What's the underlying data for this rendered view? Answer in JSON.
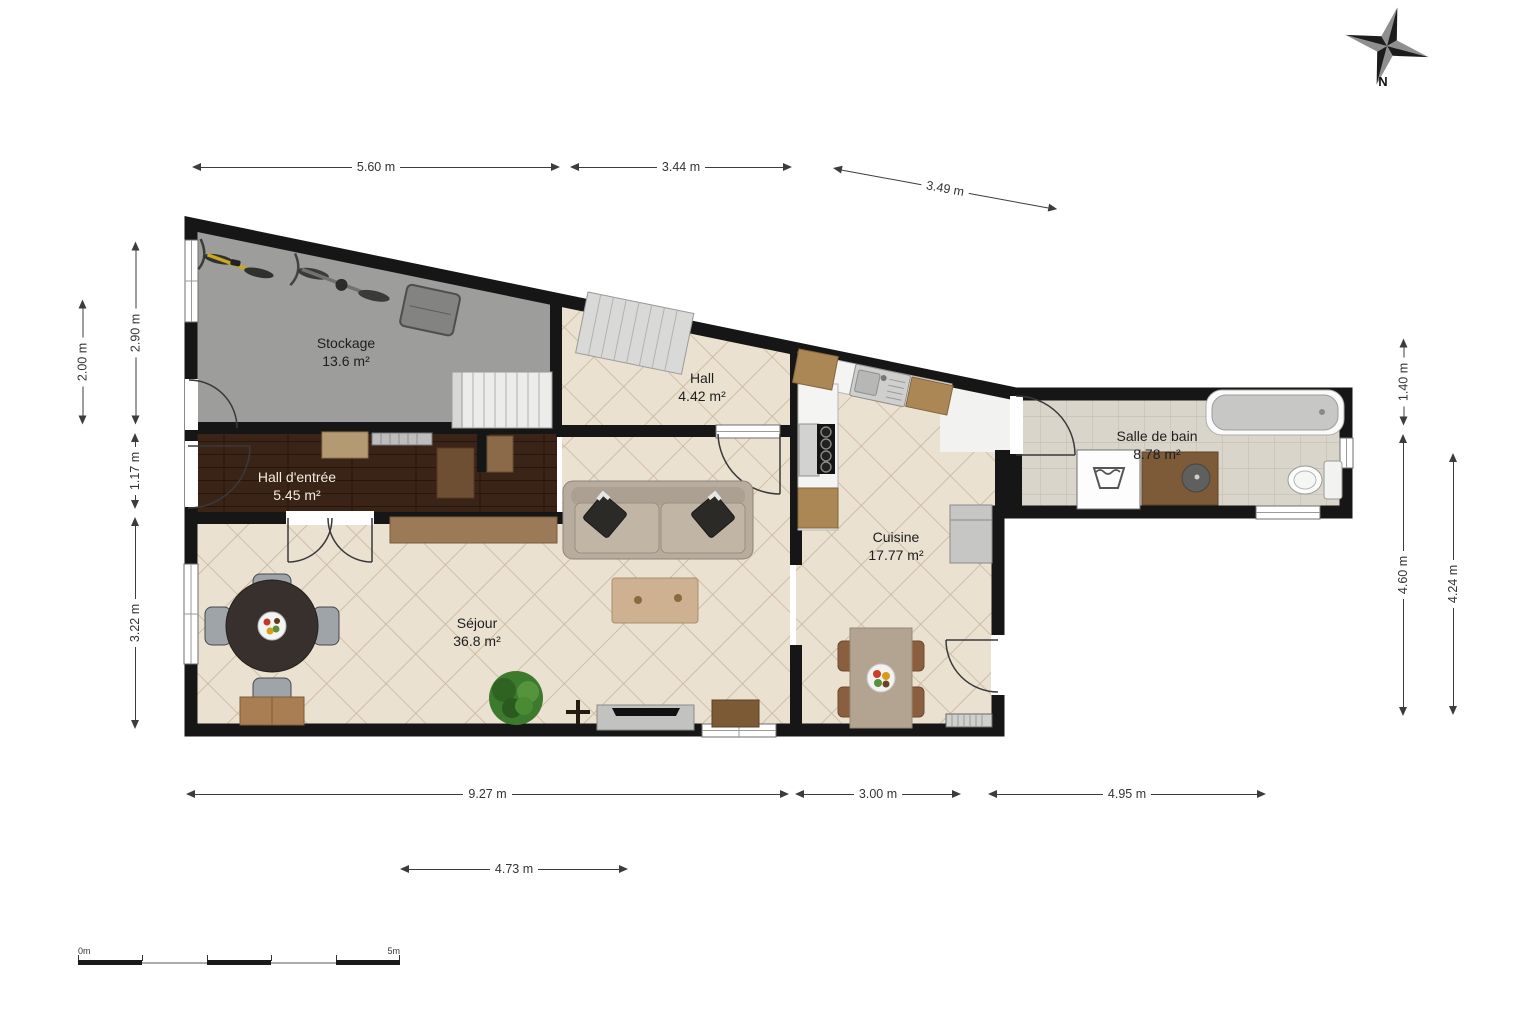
{
  "compass": {
    "label": "N"
  },
  "scale_bar": {
    "start_label": "0m",
    "end_label": "5m"
  },
  "rooms": [
    {
      "id": "stockage",
      "name": "Stockage",
      "area": "13.6 m²",
      "floor": "concrete"
    },
    {
      "id": "hall",
      "name": "Hall",
      "area": "4.42 m²",
      "floor": "tile"
    },
    {
      "id": "hall-entree",
      "name": "Hall d'entrée",
      "area": "5.45 m²",
      "floor": "dark-wood"
    },
    {
      "id": "salle-de-bain",
      "name": "Salle de bain",
      "area": "8.78 m²",
      "floor": "bath-tile"
    },
    {
      "id": "cuisine",
      "name": "Cuisine",
      "area": "17.77 m²",
      "floor": "tile"
    },
    {
      "id": "sejour",
      "name": "Séjour",
      "area": "36.8 m²",
      "floor": "tile"
    }
  ],
  "dimensions": {
    "top": [
      {
        "label": "5.60 m"
      },
      {
        "label": "3.44 m"
      },
      {
        "label": "3.49 m"
      }
    ],
    "left": [
      {
        "label": "2.00 m"
      },
      {
        "label": "2.90 m"
      },
      {
        "label": "1.17 m"
      },
      {
        "label": "3.22 m"
      }
    ],
    "right": [
      {
        "label": "1.40 m"
      },
      {
        "label": "4.60 m"
      },
      {
        "label": "4.24 m"
      }
    ],
    "bottom": [
      {
        "label": "9.27 m"
      },
      {
        "label": "3.00 m"
      },
      {
        "label": "4.95 m"
      },
      {
        "label": "4.73 m"
      }
    ]
  },
  "colors": {
    "wall": "#161616",
    "tile_floor": "#ebe1d1",
    "tile_line": "#c7b49c",
    "wood_floor": "#3a2317",
    "concrete_floor": "#9d9d9b",
    "bath_floor": "#d9d5ca",
    "dimension": "#3c3c3c"
  }
}
